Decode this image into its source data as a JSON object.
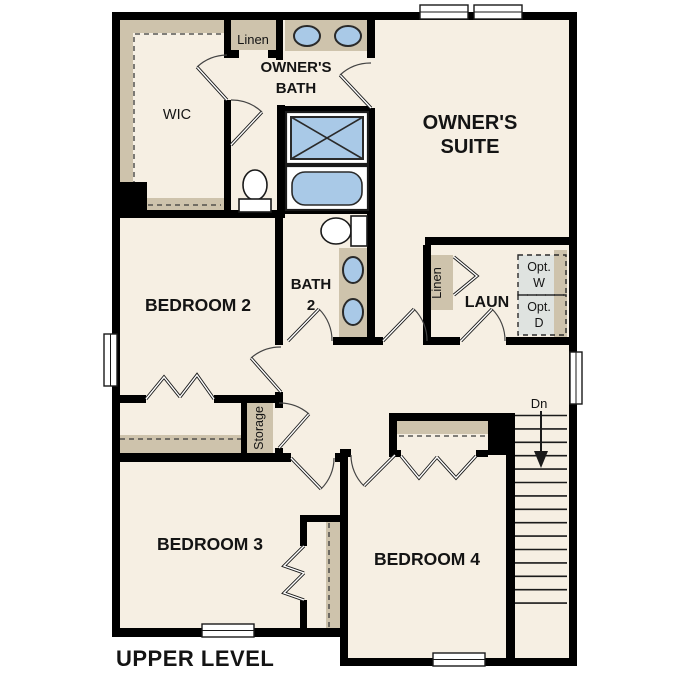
{
  "plan": {
    "title": "UPPER LEVEL",
    "rooms": {
      "owners_suite": {
        "line1": "OWNER'S",
        "line2": "SUITE"
      },
      "owners_bath": {
        "line1": "OWNER'S",
        "line2": "BATH"
      },
      "wic": {
        "label": "WIC"
      },
      "linen_top": {
        "label": "Linen"
      },
      "bedroom2": {
        "label": "BEDROOM 2"
      },
      "bath2": {
        "line1": "BATH",
        "line2": "2"
      },
      "laundry": {
        "label": "LAUN"
      },
      "linen_laundry": {
        "label": "Linen"
      },
      "opt_washer": {
        "line1": "Opt.",
        "line2": "W"
      },
      "opt_dryer": {
        "line1": "Opt.",
        "line2": "D"
      },
      "storage": {
        "label": "Storage"
      },
      "bedroom3": {
        "label": "BEDROOM 3"
      },
      "bedroom4": {
        "label": "BEDROOM 4"
      }
    },
    "stairs": {
      "label": "Dn",
      "treads": 15
    },
    "colors": {
      "wall": "#000000",
      "floor": "#f6efe3",
      "casework": "#cec3ac",
      "fixture_blue": "#a9c9e7",
      "fixture_outline": "#2a2a2a",
      "optional_fill": "#dfe3e0",
      "outside": "#ffffff"
    }
  }
}
